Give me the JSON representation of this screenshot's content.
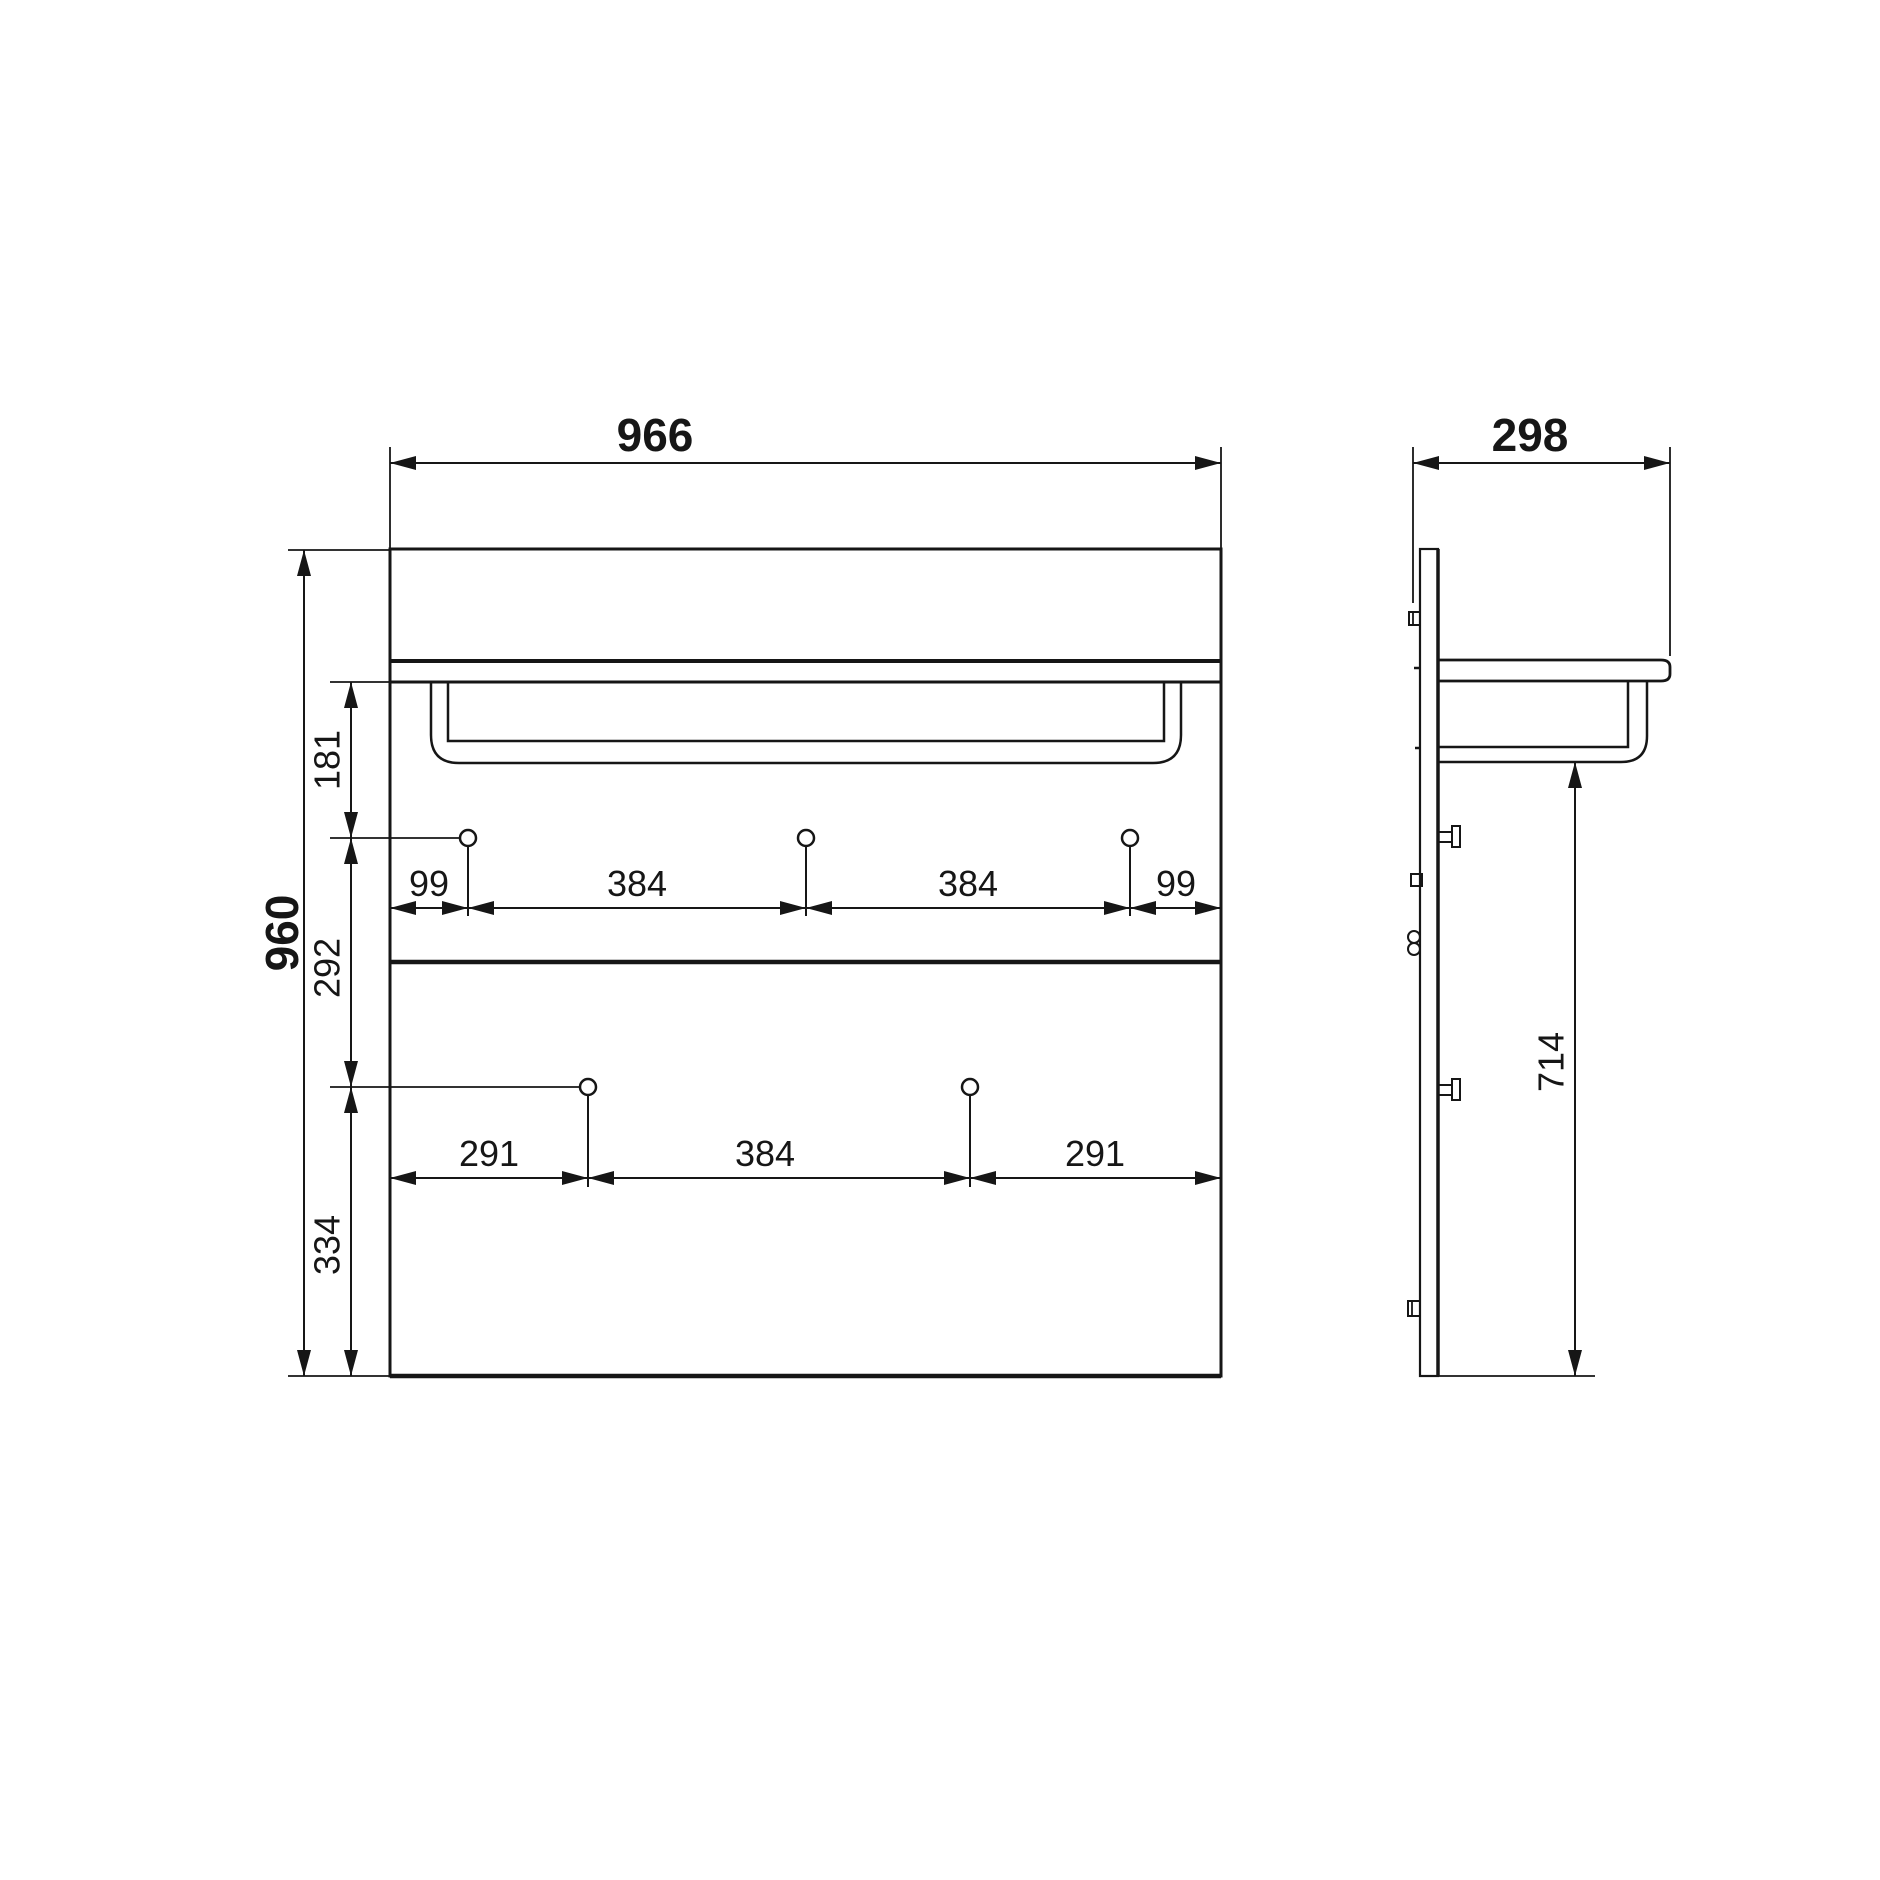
{
  "front_view": {
    "overall_width": "966",
    "overall_height": "960",
    "left_height_dims": [
      "181",
      "292",
      "334"
    ],
    "top_hook_row_dims": [
      "99",
      "384",
      "384",
      "99"
    ],
    "bottom_hook_row_dims": [
      "291",
      "384",
      "291"
    ]
  },
  "side_view": {
    "overall_depth": "298",
    "rail_to_bottom_height": "714"
  }
}
